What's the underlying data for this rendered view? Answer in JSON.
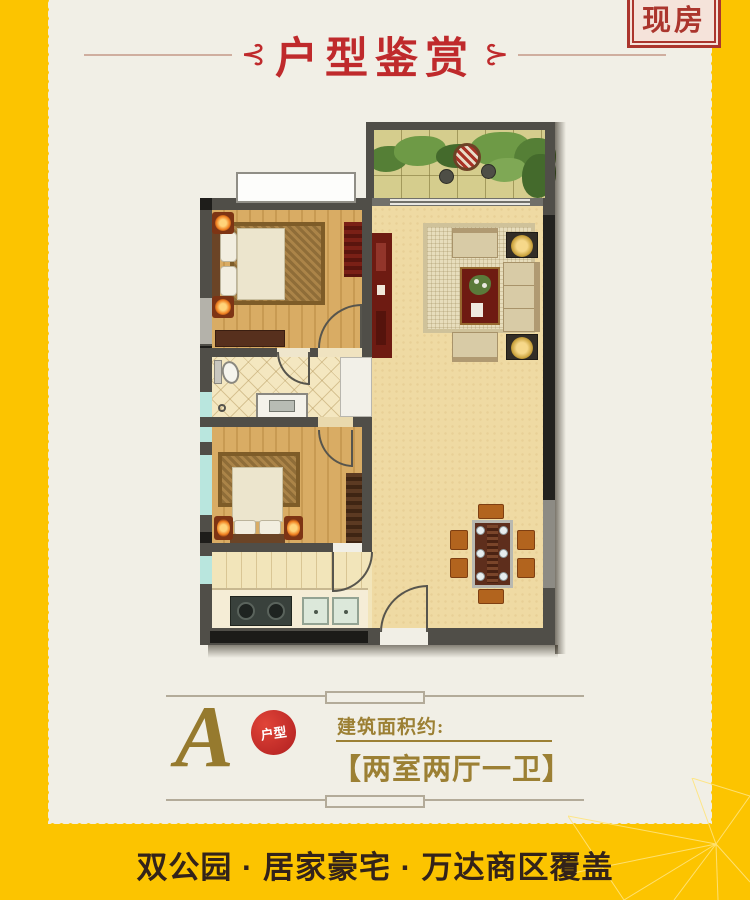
{
  "badge": {
    "label": "现房"
  },
  "header": {
    "ornament_left": "⊰",
    "ornament_right": "⊱",
    "title": "户型鉴赏"
  },
  "floor_plan": {
    "description": "two-bedroom apartment floor plan rendered top-down",
    "rooms": [
      "balcony",
      "living-room",
      "dining-area",
      "bedroom-1",
      "bathroom",
      "bedroom-2",
      "kitchen"
    ]
  },
  "unit": {
    "letter": "A",
    "letter_badge": "户型",
    "area_label": "建筑面积约:",
    "layout": "【两室两厅一卫】"
  },
  "footer": {
    "slogan": "双公园 · 居家豪宅 · 万达商区覆盖"
  },
  "colors": {
    "background_yellow": "#fcc400",
    "card_cream": "#f1efe6",
    "title_red": "#bf2a2c",
    "gold": "#9c8034",
    "slogan_brown": "#33231a"
  }
}
